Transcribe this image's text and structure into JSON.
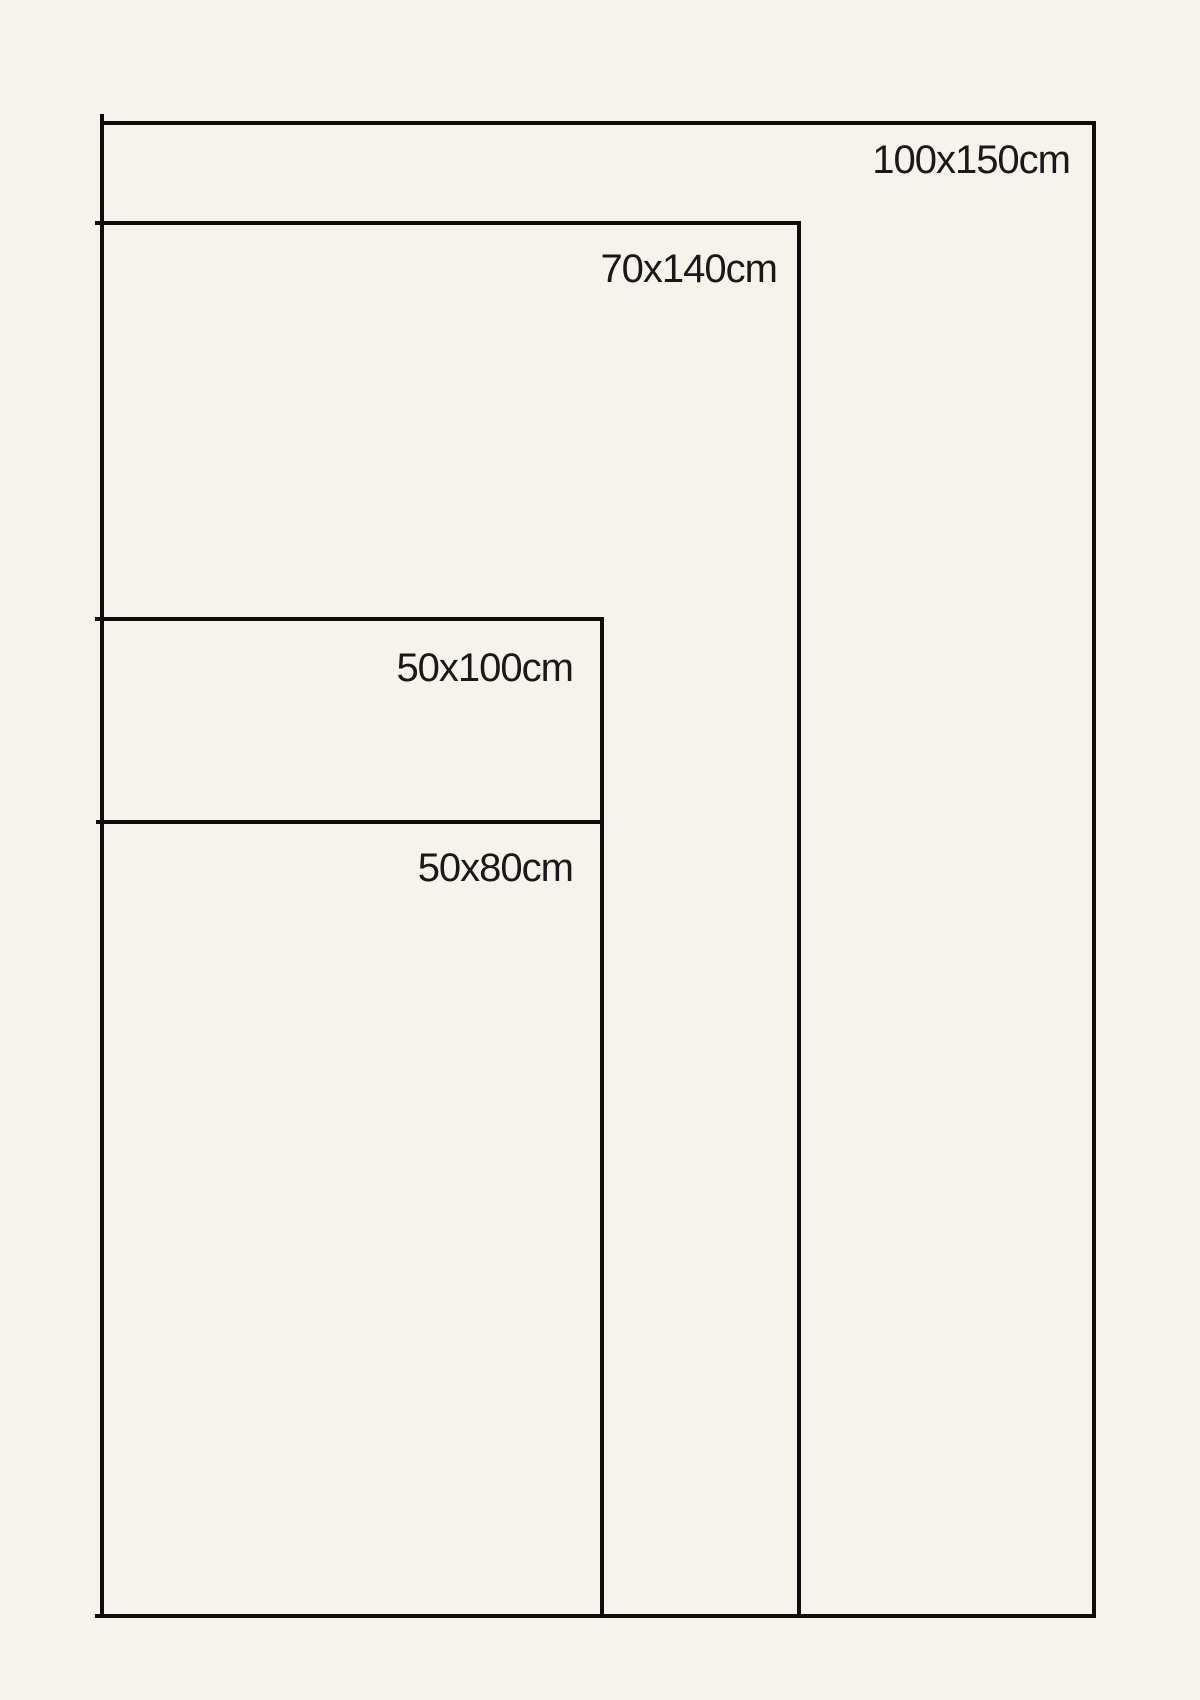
{
  "diagram": {
    "kind": "size-comparison",
    "unit": "cm",
    "sizes": [
      {
        "label": "100x150cm",
        "width_cm": 100,
        "height_cm": 150
      },
      {
        "label": "70x140cm",
        "width_cm": 70,
        "height_cm": 140
      },
      {
        "label": "50x100cm",
        "width_cm": 50,
        "height_cm": 100
      },
      {
        "label": "50x80cm",
        "width_cm": 50,
        "height_cm": 80
      }
    ]
  },
  "colors": {
    "background": "#f6f3ed",
    "line": "#0d0d0d",
    "text": "#191919"
  }
}
